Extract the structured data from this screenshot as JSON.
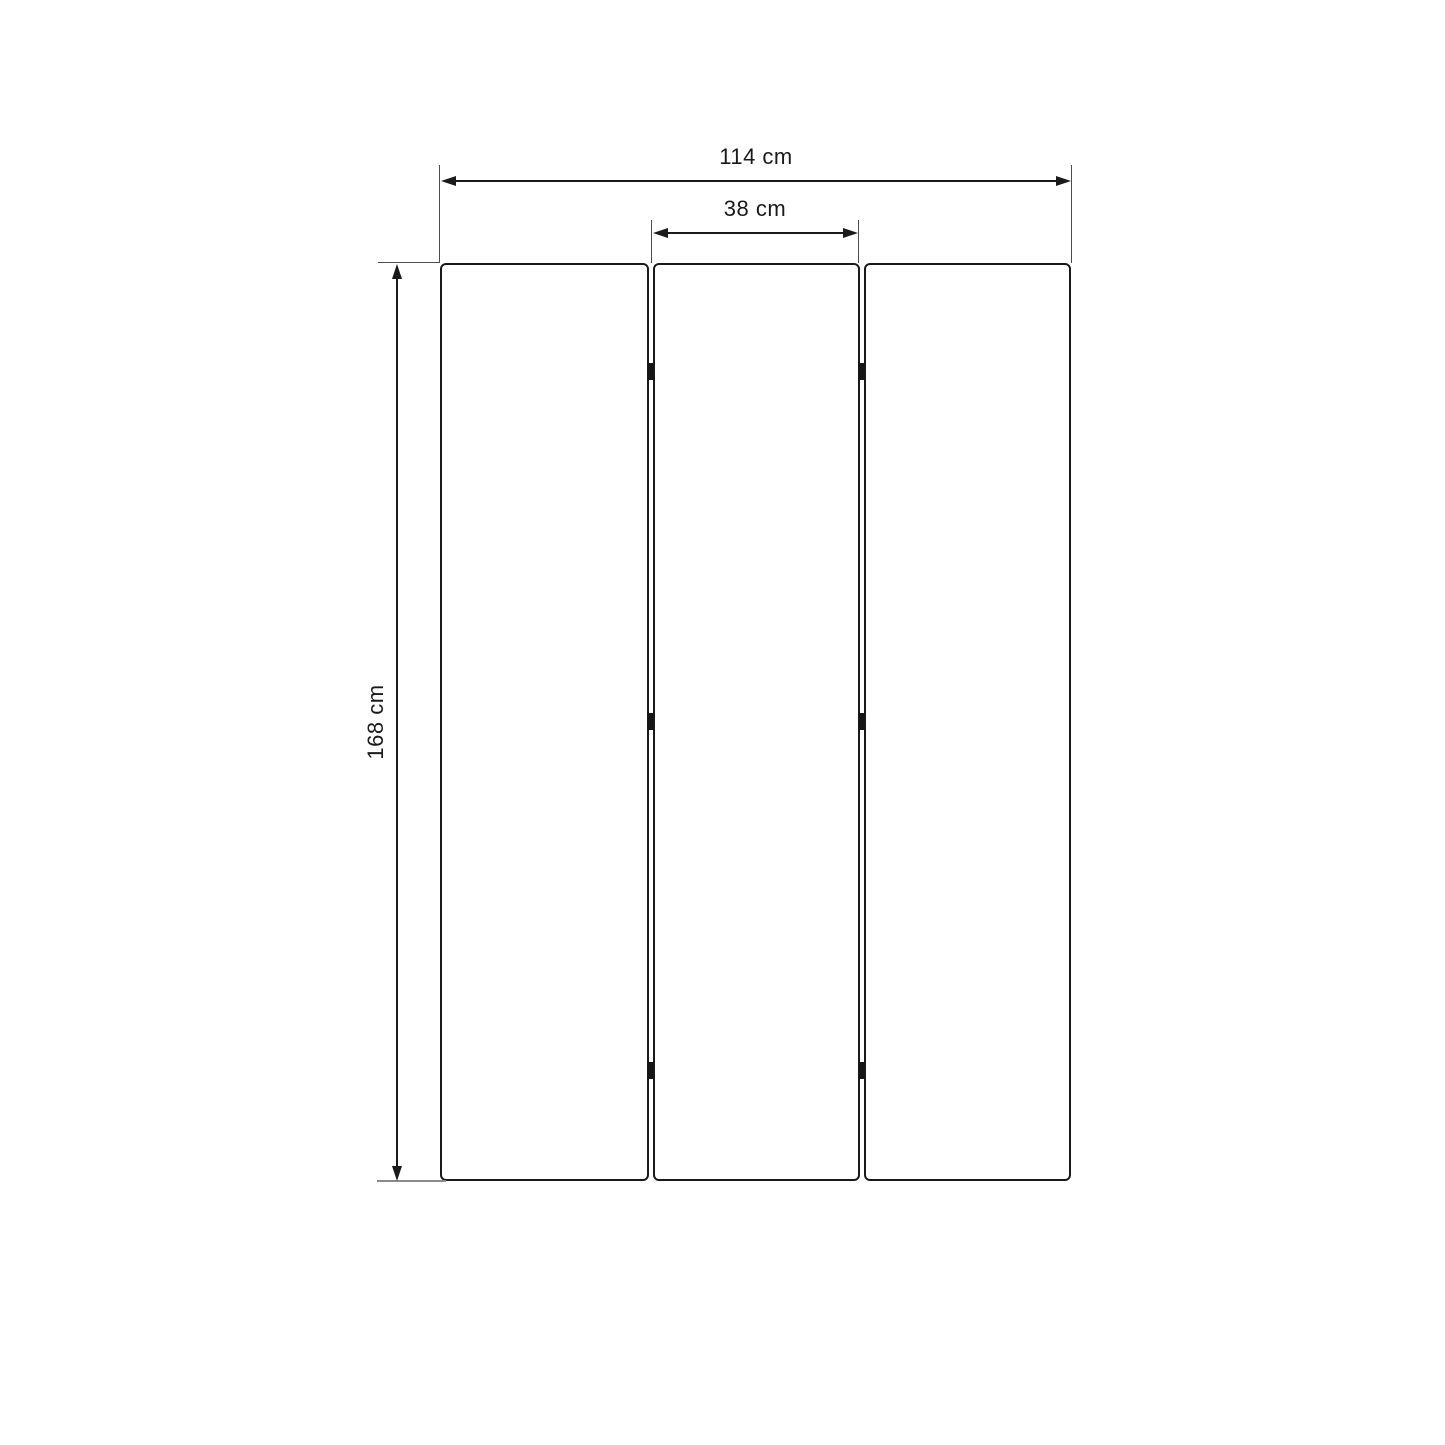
{
  "diagram": {
    "type": "dimension-drawing",
    "subject": "three-panel folding screen, front elevation",
    "panel_count": 3,
    "hinge_rows": 3,
    "labels": {
      "total_width": "114 cm",
      "panel_width": "38 cm",
      "height": "168 cm"
    },
    "colors": {
      "background": "#ffffff",
      "outline": "#1a1a1a",
      "extension_line": "#4d4d4d",
      "baseline": "#8a8a8a",
      "text": "#1a1a1a"
    }
  }
}
